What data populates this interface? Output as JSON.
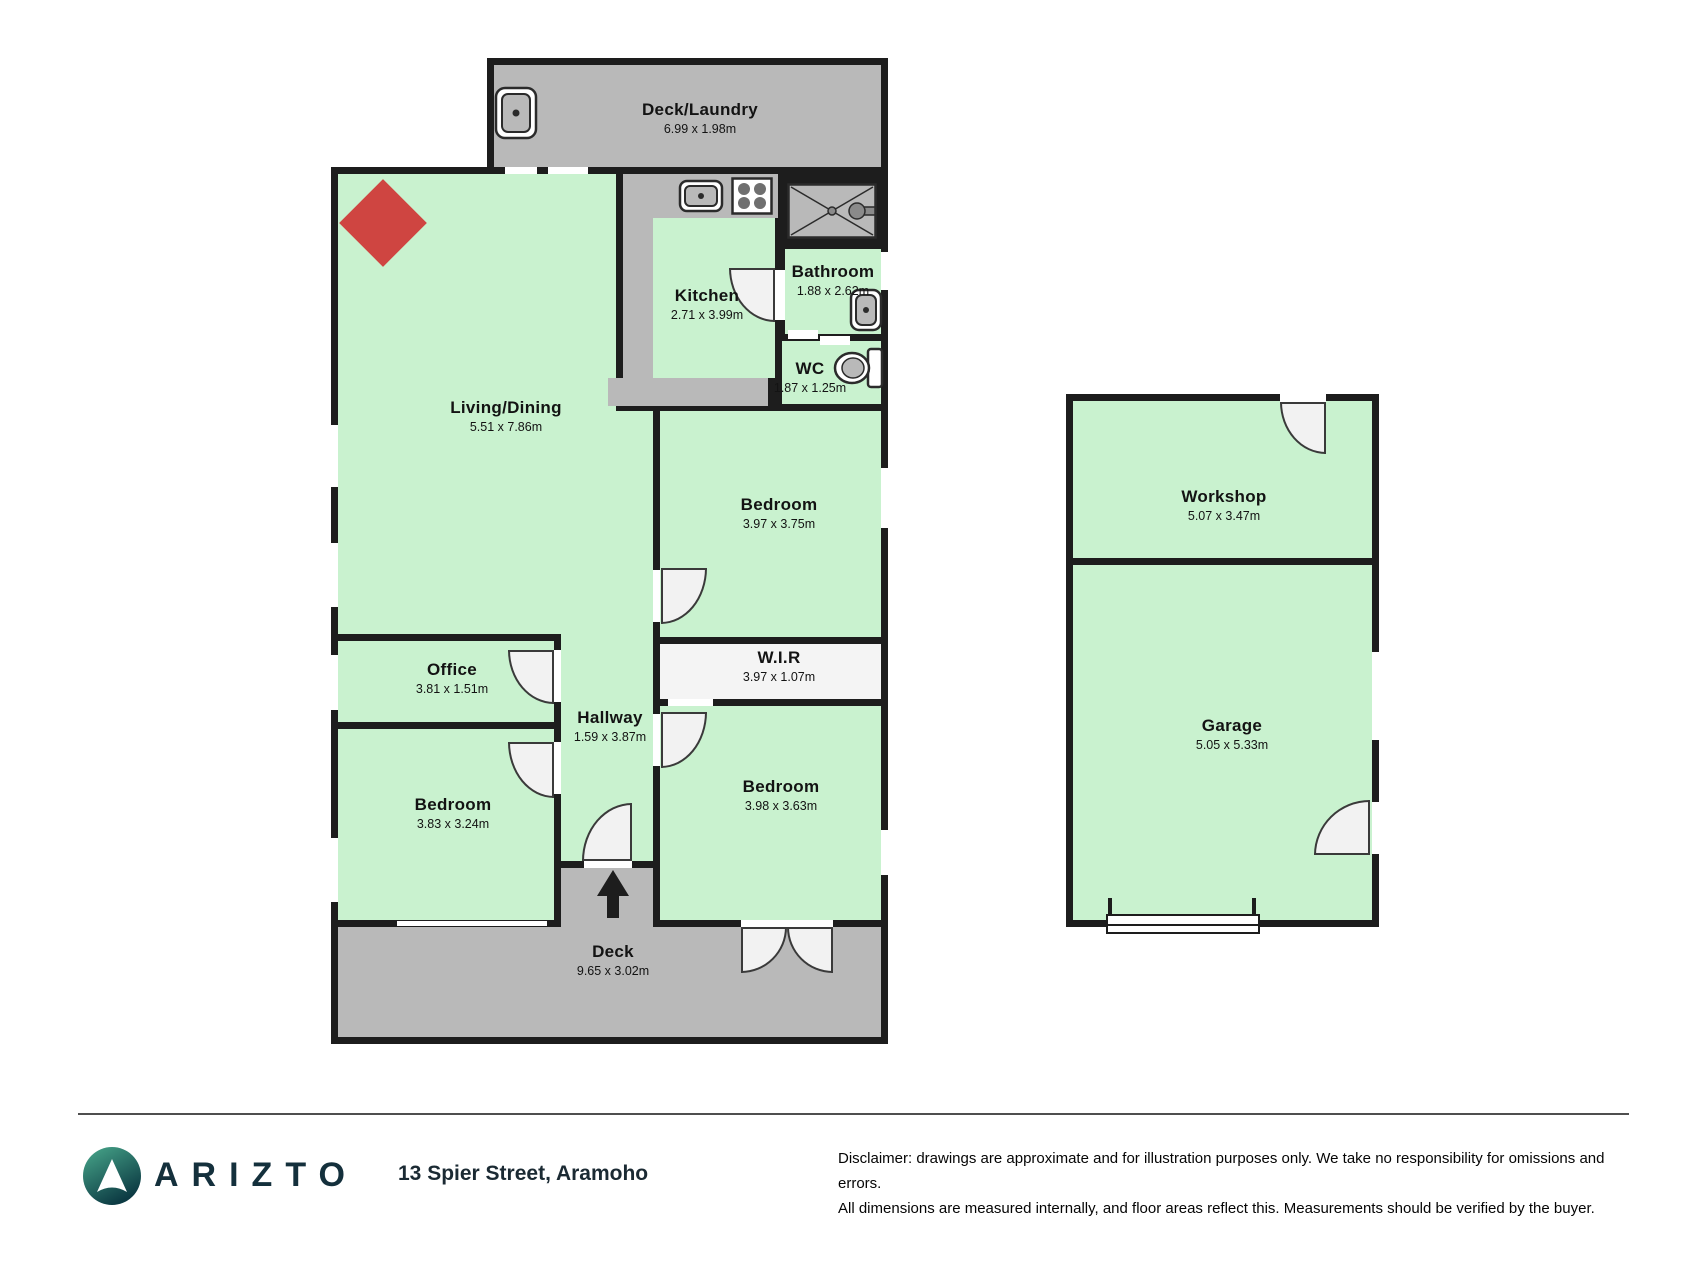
{
  "floorplan": {
    "rooms": [
      {
        "id": "deck-laundry",
        "name": "Deck/Laundry",
        "dims": "6.99 x 1.98m"
      },
      {
        "id": "kitchen",
        "name": "Kitchen",
        "dims": "2.71 x 3.99m"
      },
      {
        "id": "bathroom",
        "name": "Bathroom",
        "dims": "1.88 x 2.62m"
      },
      {
        "id": "wc",
        "name": "WC",
        "dims": "1.87 x 1.25m"
      },
      {
        "id": "living-dining",
        "name": "Living/Dining",
        "dims": "5.51 x 7.86m"
      },
      {
        "id": "bedroom-top-right",
        "name": "Bedroom",
        "dims": "3.97 x 3.75m"
      },
      {
        "id": "wir",
        "name": "W.I.R",
        "dims": "3.97 x 1.07m"
      },
      {
        "id": "office",
        "name": "Office",
        "dims": "3.81 x 1.51m"
      },
      {
        "id": "hallway",
        "name": "Hallway",
        "dims": "1.59 x 3.87m"
      },
      {
        "id": "bedroom-bottom-left",
        "name": "Bedroom",
        "dims": "3.83 x 3.24m"
      },
      {
        "id": "bedroom-bottom-right",
        "name": "Bedroom",
        "dims": "3.98 x 3.63m"
      },
      {
        "id": "deck",
        "name": "Deck",
        "dims": "9.65 x 3.02m"
      },
      {
        "id": "workshop",
        "name": "Workshop",
        "dims": "5.07 x 3.47m"
      },
      {
        "id": "garage",
        "name": "Garage",
        "dims": "5.05 x 5.33m"
      }
    ],
    "icons": [
      "laundry-sink",
      "kitchen-sink",
      "stove",
      "shower",
      "bathroom-sink",
      "toilet",
      "fireplace",
      "entry-arrow"
    ],
    "colors": {
      "room_fill": "#c9f2cf",
      "gray_fill": "#b9b9b9",
      "wall": "#1d1d1d",
      "wir_fill": "#f4f4f4",
      "fireplace_red": "#cf4541"
    }
  },
  "footer": {
    "brand": "ARIZTO",
    "address": "13 Spier Street, Aramoho",
    "disclaimer_line1": "Disclaimer: drawings are approximate and for illustration purposes only. We take no responsibility for omissions and errors.",
    "disclaimer_line2": "All dimensions are measured internally, and floor areas reflect this. Measurements should be verified by the buyer.",
    "brand_color": "#14303c",
    "logo_teal_light": "#49a98c",
    "logo_teal_dark": "#0c3a43"
  }
}
